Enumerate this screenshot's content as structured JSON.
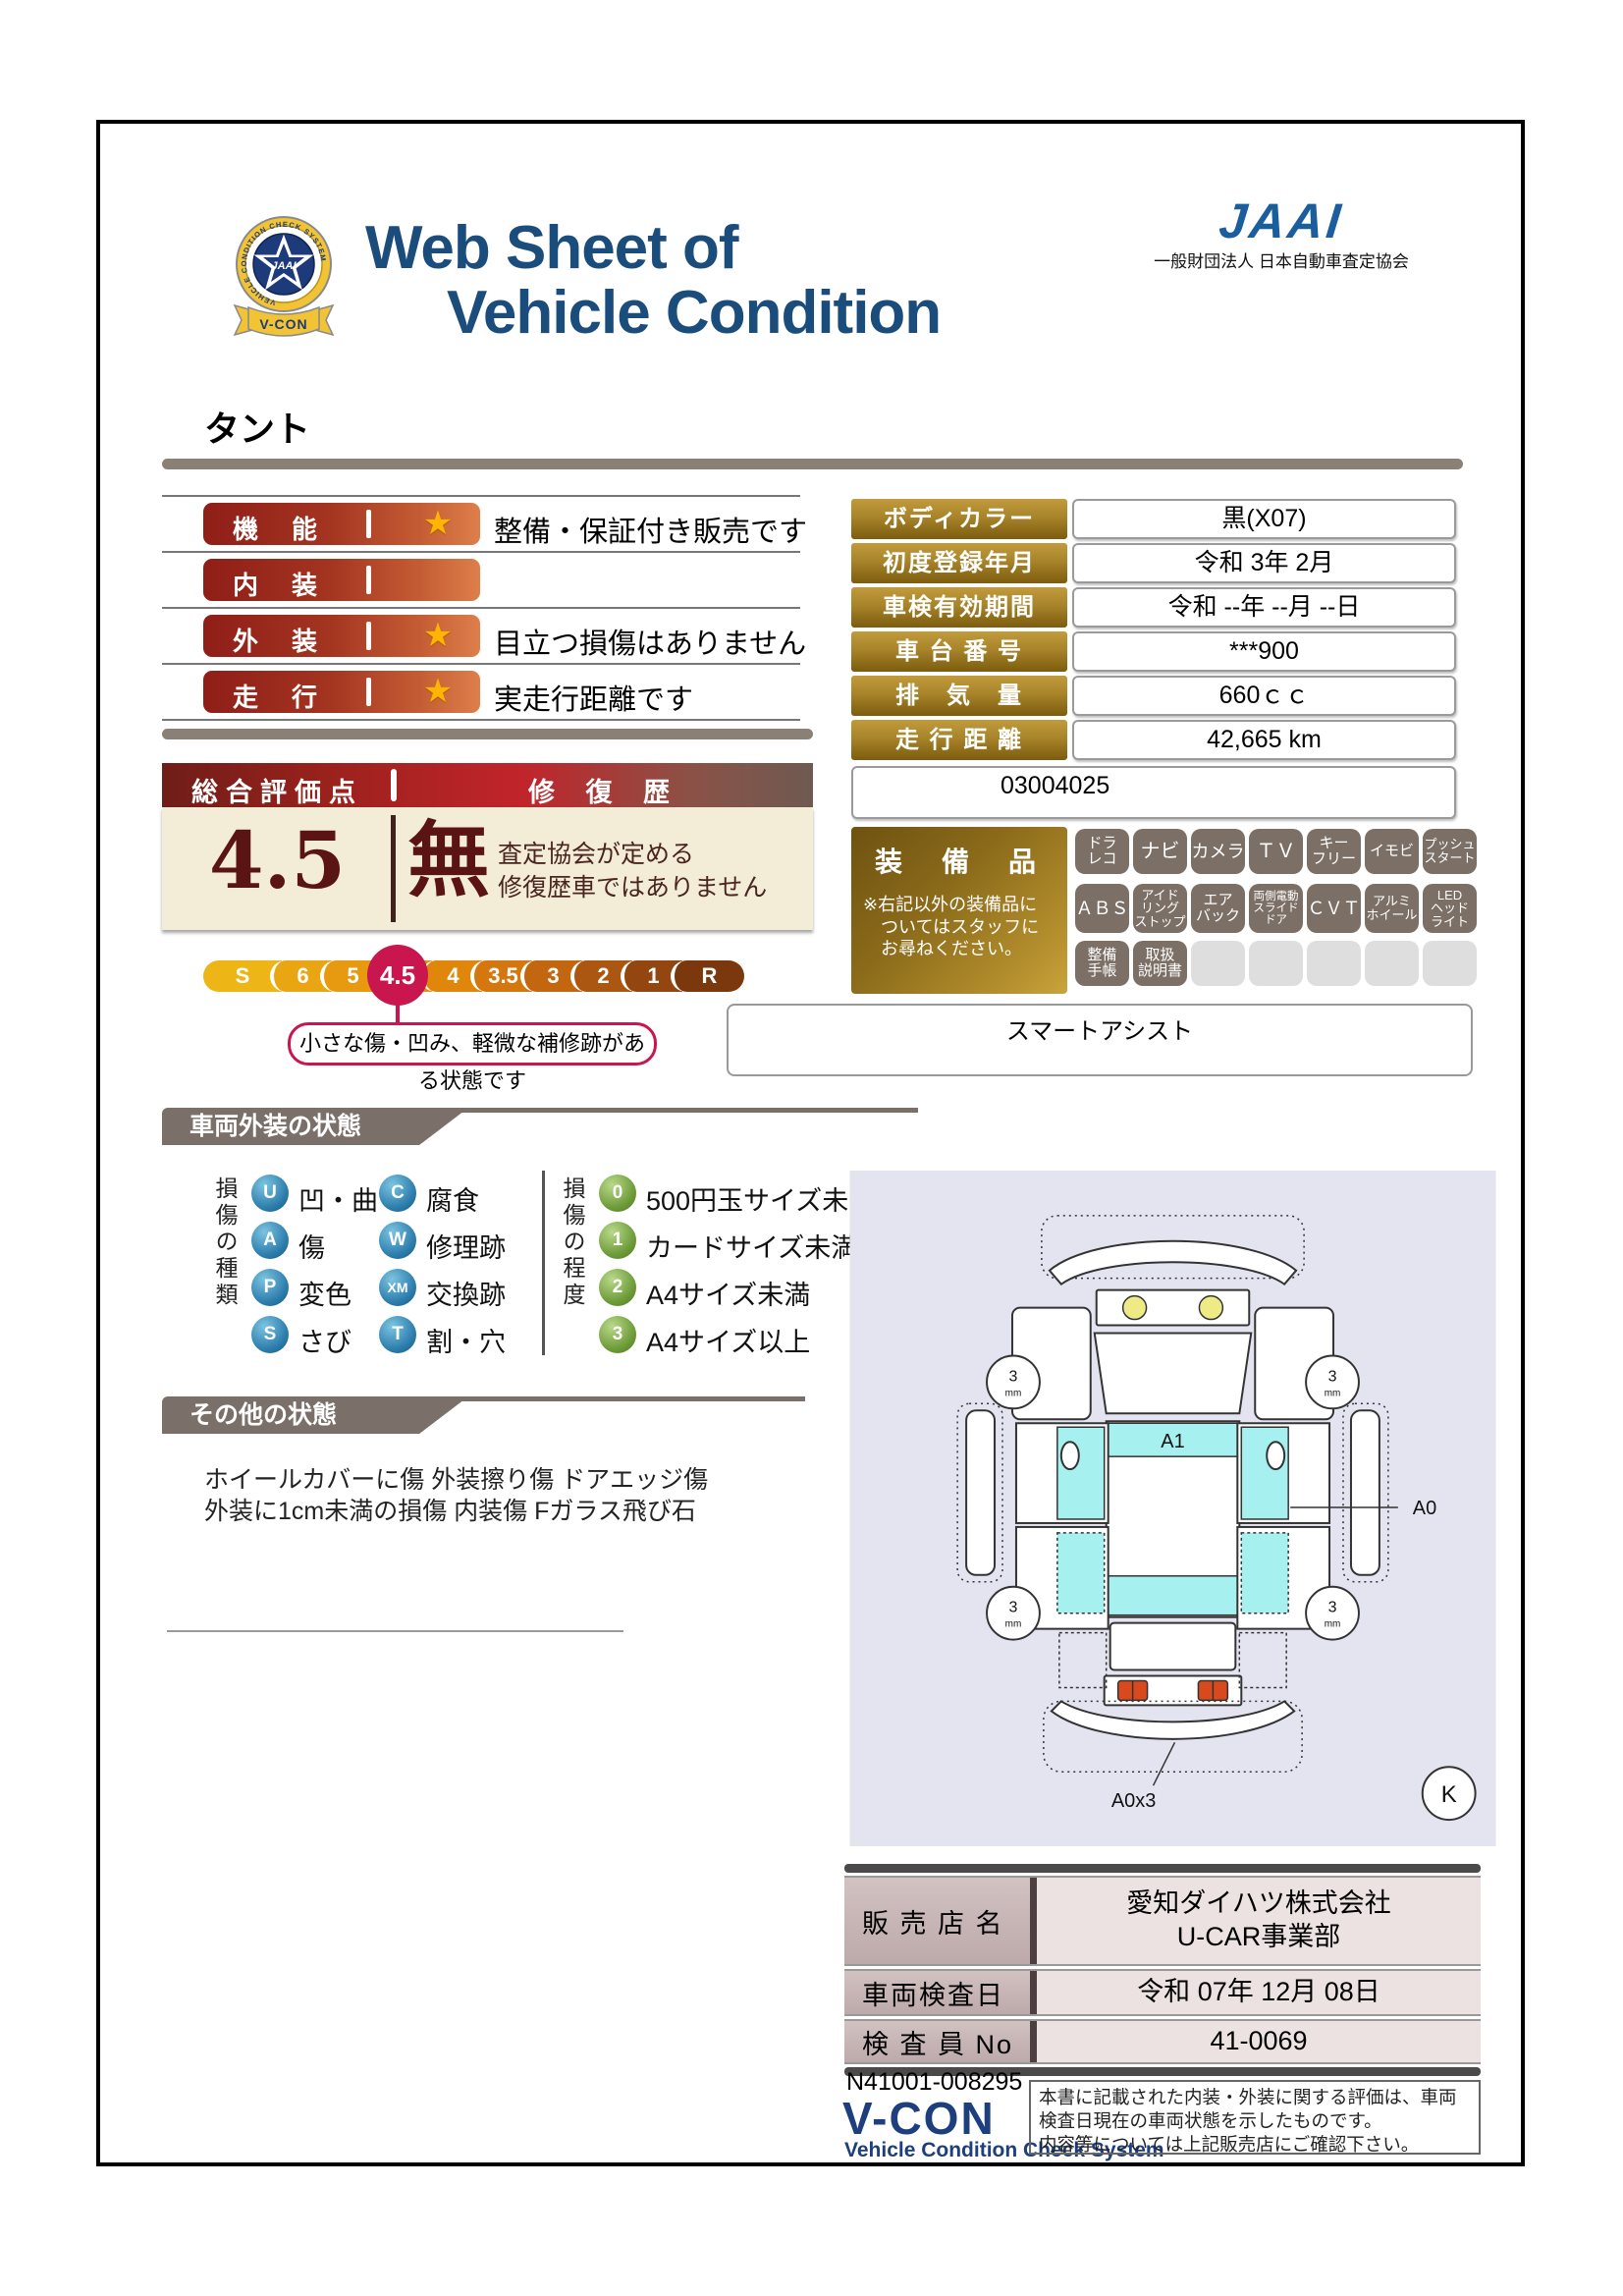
{
  "header": {
    "title_line1": "Web Sheet of",
    "title_line2": "Vehicle Condition",
    "jaai_logo_text": "JAAI",
    "jaai_org": "一般財団法人 日本自動車査定協会",
    "badge_center": "JAAI",
    "badge_ribbon": "V-CON",
    "badge_ring_text": "VEHICLE CONDITION CHECK SYSTEM"
  },
  "vehicle_name": "タント",
  "icons": {
    "star": "★"
  },
  "ratings": [
    {
      "label": "機　能",
      "comment": "整備・保証付き販売です"
    },
    {
      "label": "内　装",
      "comment": ""
    },
    {
      "label": "外　装",
      "comment": "目立つ損傷はありません"
    },
    {
      "label": "走　行",
      "comment": "実走行距離です"
    }
  ],
  "overall": {
    "header_left": "総合評価点",
    "header_right": "修 復 歴",
    "score": "4.5",
    "repair_flag": "無",
    "repair_line1": "査定協会が定める",
    "repair_line2": "修復歴車ではありません",
    "scale": [
      "S",
      "6",
      "5",
      "4.5",
      "4",
      "3.5",
      "3",
      "2",
      "1",
      "R"
    ],
    "selected": "4.5",
    "callout": "小さな傷・凹み、軽微な補修跡がある状態です"
  },
  "info": {
    "rows": [
      {
        "label": "ボディカラー",
        "value": "黒(X07)"
      },
      {
        "label": "初度登録年月",
        "value": "令和 3年 2月"
      },
      {
        "label": "車検有効期間",
        "value": "令和 --年 --月 --日"
      },
      {
        "label": "車 台 番 号",
        "value": "***900"
      },
      {
        "label": "排　気　量",
        "value": "660ｃｃ"
      },
      {
        "label": "走 行 距 離",
        "value": "42,665 km"
      }
    ],
    "note": "03004025"
  },
  "equipment": {
    "title": "装　備　品",
    "note1": "※右記以外の装備品に",
    "note2": "ついてはスタッフに",
    "note3": "お尋ねください。",
    "badges_row1": [
      "ドラ\nレコ",
      "ナビ",
      "カメラ",
      "ＴＶ",
      "キー\nフリー",
      "イモビ",
      "プッシュ\nスタート"
    ],
    "badges_row2": [
      "ＡＢＳ",
      "アイド\nリング\nストップ",
      "エア\nバック",
      "両側電動\nスライド\nドア",
      "ＣＶＴ",
      "アルミ\nホイール",
      "LED\nヘッド\nライト"
    ],
    "badges_row3": [
      "整備\n手帳",
      "取扱\n説明書"
    ],
    "smart": "スマートアシスト"
  },
  "exterior_section": {
    "title": "車両外装の状態",
    "types_label": "損傷の種類",
    "types": [
      {
        "code": "U",
        "label": "凹・曲"
      },
      {
        "code": "C",
        "label": "腐食"
      },
      {
        "code": "A",
        "label": "傷"
      },
      {
        "code": "W",
        "label": "修理跡"
      },
      {
        "code": "P",
        "label": "変色"
      },
      {
        "code": "XM",
        "label": "交換跡"
      },
      {
        "code": "S",
        "label": "さび"
      },
      {
        "code": "T",
        "label": "割・穴"
      }
    ],
    "degree_label": "損傷の程度",
    "degrees": [
      {
        "code": "0",
        "label": "500円玉サイズ未満"
      },
      {
        "code": "1",
        "label": "カードサイズ未満"
      },
      {
        "code": "2",
        "label": "A4サイズ未満"
      },
      {
        "code": "3",
        "label": "A4サイズ以上"
      }
    ]
  },
  "other_section": {
    "title": "その他の状態",
    "line1": "ホイールカバーに傷 外装擦り傷 ドアエッジ傷",
    "line2": "外装に1cm未満の損傷 内装傷 Fガラス飛び石"
  },
  "diagram": {
    "roof_label": "A1",
    "side_label": "A0",
    "rear_label": "A0x3",
    "corner_label": "K",
    "tire_value": "3",
    "tire_unit": "mm"
  },
  "dealer": {
    "rows": [
      {
        "label": "販 売 店 名",
        "value_line1": "愛知ダイハツ株式会社",
        "value_line2": "U-CAR事業部"
      },
      {
        "label": "車両検査日",
        "value_line1": "令和 07年 12月 08日"
      },
      {
        "label": "検 査 員 No",
        "value_line1": "41-0069"
      }
    ]
  },
  "footer": {
    "doc_no": "N41001-008295",
    "vcon": "V-CON",
    "vcon_sub": "Vehicle Condition Check System",
    "disc1": "本書に記載された内装・外装に関する評価は、車両",
    "disc2": "検査日現在の車両状態を示したものです。",
    "disc3": "内容等については上記販売店にご確認下さい。"
  }
}
